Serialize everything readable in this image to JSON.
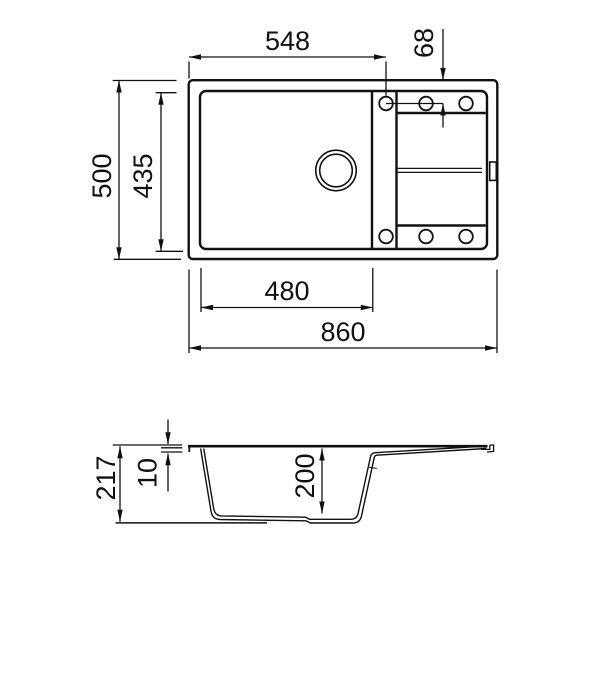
{
  "colors": {
    "line": "#111111",
    "background": "#ffffff"
  },
  "views": {
    "top": "sink plan view",
    "side": "sink section view"
  },
  "dims": {
    "d548": "548",
    "d68": "68",
    "d500": "500",
    "d435": "435",
    "d480": "480",
    "d860": "860",
    "d217": "217",
    "d10": "10",
    "d200": "200"
  }
}
